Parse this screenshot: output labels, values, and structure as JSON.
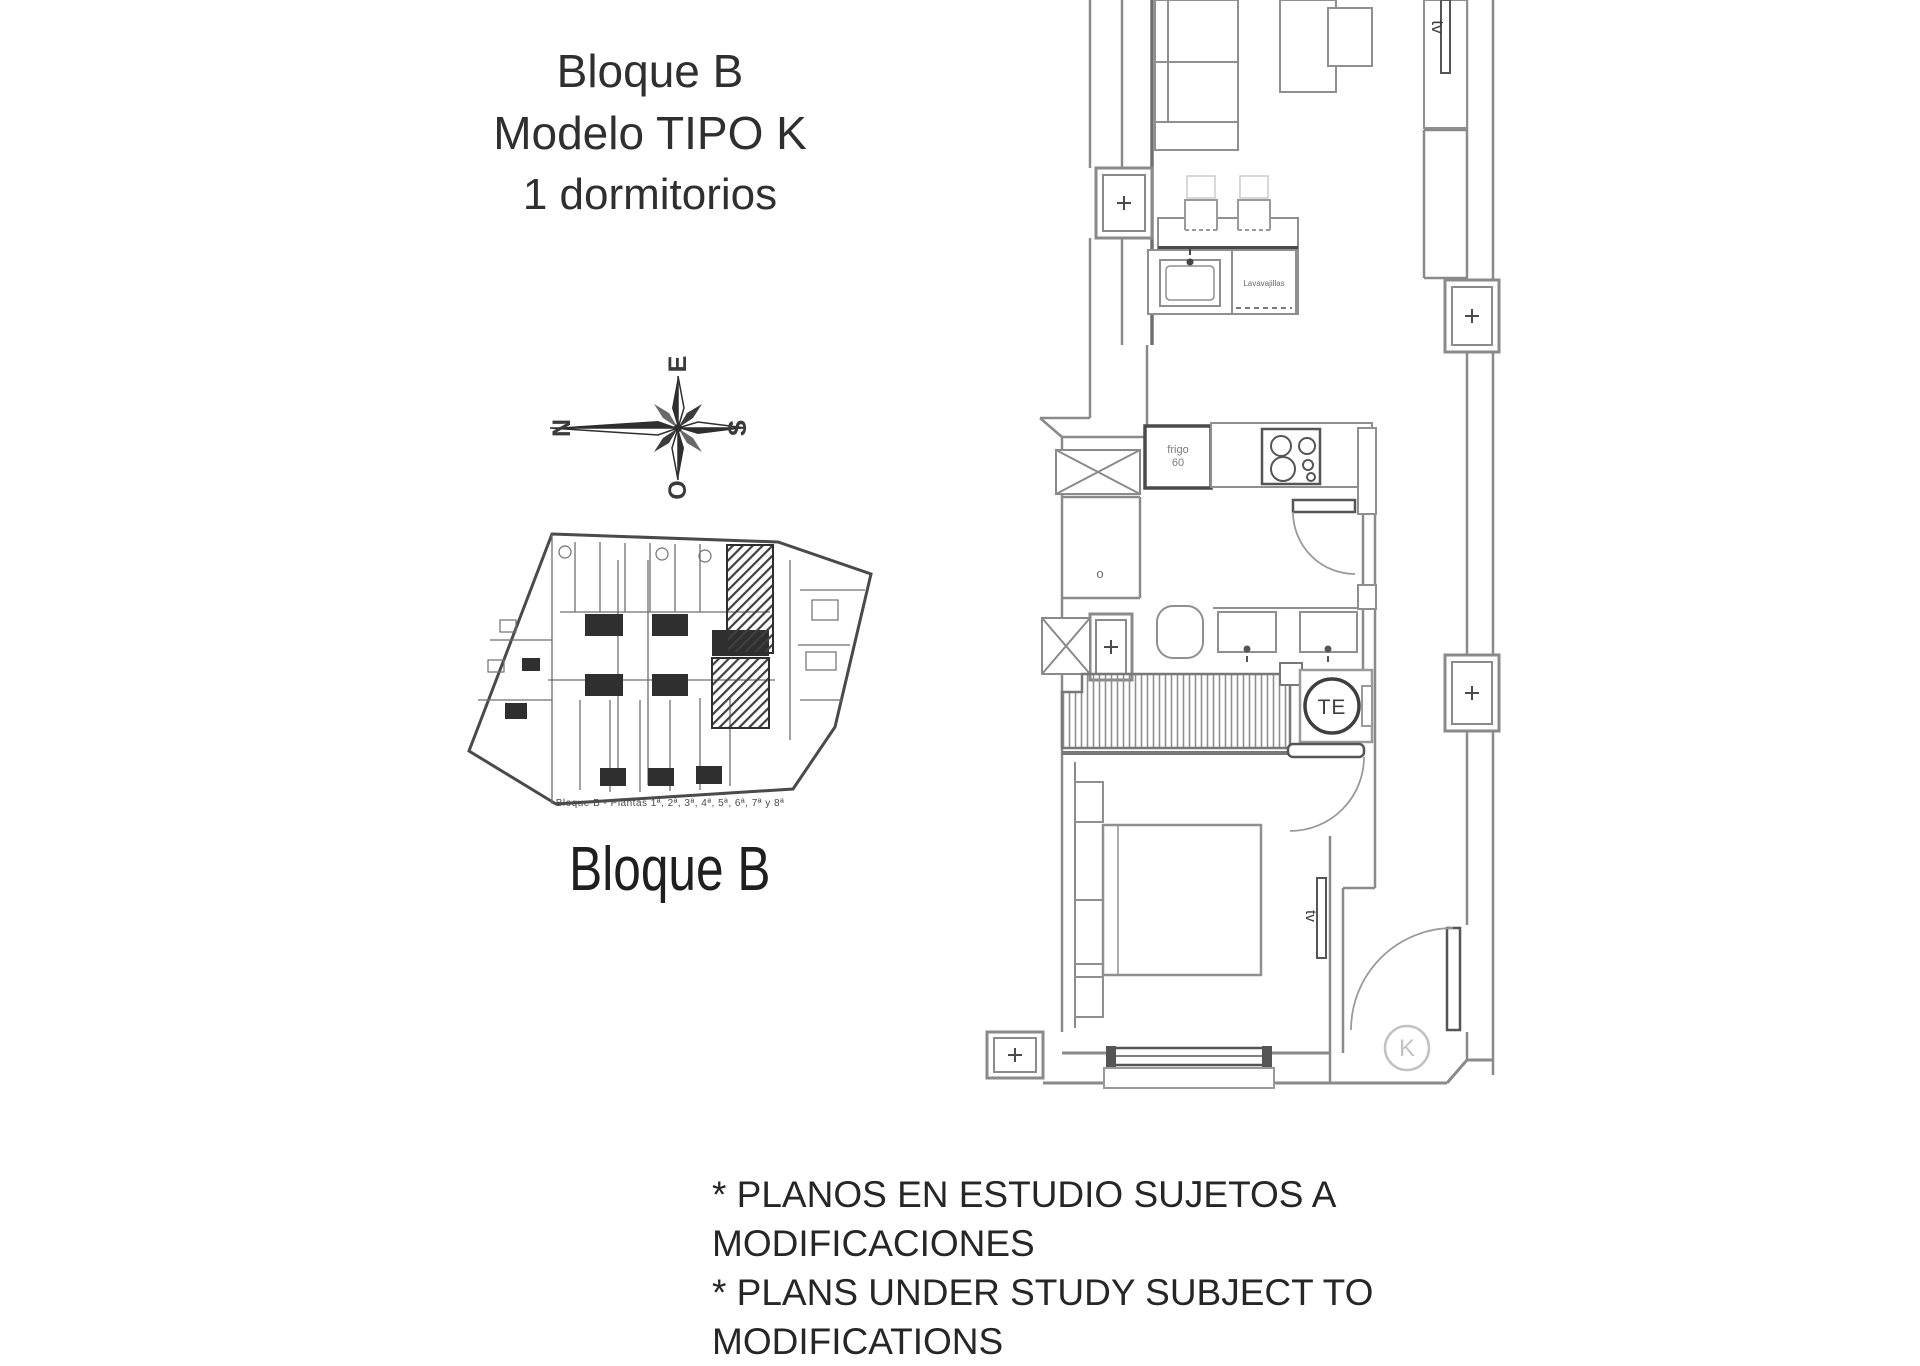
{
  "header": {
    "block": "Bloque B",
    "model": "Modelo TIPO K",
    "bedrooms": "1 dormitorios"
  },
  "compass": {
    "n": "N",
    "e": "E",
    "s": "S",
    "o": "O"
  },
  "block_plan": {
    "caption": "Bloque B - Plantas 1ª, 2ª, 3ª, 4ª, 5ª, 6ª, 7ª y 8ª",
    "title": "Bloque B"
  },
  "plan": {
    "tv_living": "tv",
    "tv_bedroom": "tv",
    "fridge_line1": "frigo",
    "fridge_line2": "60",
    "dishwasher": "Lavavajillas",
    "water_heater": "TE",
    "unit_letter": "K",
    "laundry_symbol": "o"
  },
  "footer": {
    "line1": "* PLANOS EN ESTUDIO SUJETOS A MODIFICACIONES",
    "line2": "* PLANS UNDER STUDY SUBJECT TO MODIFICATIONS"
  },
  "colors": {
    "wall": "#8a8a8a",
    "wall_dark": "#555555",
    "text_dark": "#3a3a3a",
    "label_grey": "#c2c2c2",
    "background": "#ffffff"
  }
}
